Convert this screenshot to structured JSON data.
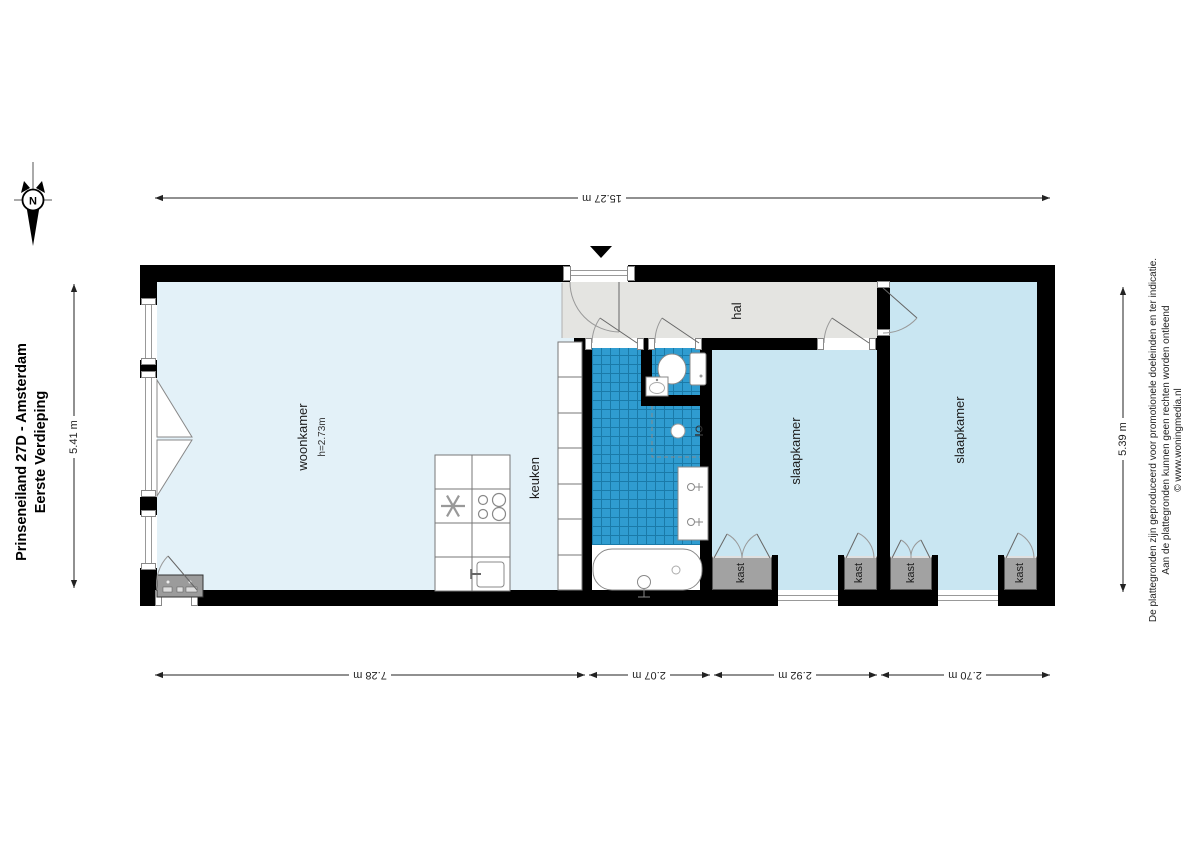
{
  "title": {
    "line1": "Prinseneiland 27D - Amsterdam",
    "line2": "Eerste Verdieping"
  },
  "compass": {
    "north": "N"
  },
  "dimensions": {
    "top": "15.27 m",
    "left": "5.41 m",
    "right": "5.39 m",
    "bottom": [
      "7.28 m",
      "2.07 m",
      "2.92 m",
      "2.70 m"
    ]
  },
  "rooms": {
    "woonkamer": {
      "label": "woonkamer",
      "ceiling_height": "h=2.73m"
    },
    "keuken": {
      "label": "keuken"
    },
    "hal": {
      "label": "hal"
    },
    "slaapkamer": {
      "label": "slaapkamer"
    },
    "kast": {
      "label": "kast"
    }
  },
  "disclaimer": {
    "line1": "De plattegronden zijn geproduceerd voor promotionele doeleinden en ter indicatie.",
    "line2": "Aan de plattegronden kunnen geen rechten worden ontleend",
    "line3": "© www.woningmedia.nl"
  },
  "icons": [
    "compass-north-icon",
    "entrance-marker-icon",
    "toilet-icon",
    "toilet-sink-icon",
    "washbasin-icon",
    "bathtub-icon",
    "shower-icon",
    "stove-icon",
    "extractor-fan-icon",
    "kitchen-sink-icon",
    "wall-unit-icon"
  ],
  "colors": {
    "wall": "#000000",
    "woonkamer_floor": "#e3f1f8",
    "slaapkamer_floor": "#c9e6f2",
    "hal_floor": "#e4e4e1",
    "bathroom_tile": "#2f9cd0",
    "bathroom_tile_grid": "#1a7aa8",
    "kast": "#a2a2a2"
  }
}
